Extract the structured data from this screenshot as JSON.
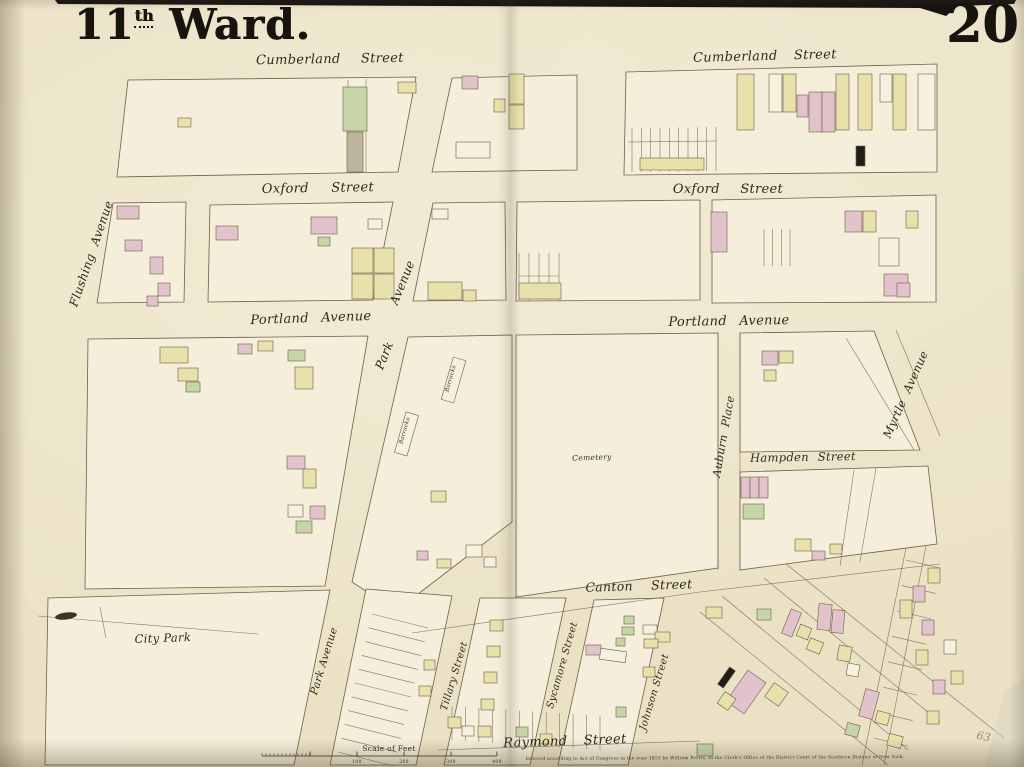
{
  "page": {
    "ward_number": "11",
    "ward_suffix": "th",
    "ward_word": "Ward.",
    "plate_number": "20"
  },
  "colors": {
    "paper": "#ebe2c6",
    "block": "#f4eeda",
    "ink": "#6b604a",
    "text_ink": "#2e2a1e",
    "pink": "#e2c2cb",
    "yellow": "#e9e1ab",
    "green": "#c8d5a9",
    "dark": "#211e18",
    "white": "#f6f1de",
    "grey": "#bdb59c",
    "pencil": "#908a76"
  },
  "map": {
    "labels": [
      {
        "n": "cumberland-street-left",
        "t": "Cumberland Street",
        "x": 330,
        "y": 63,
        "r": -1,
        "s": 13,
        "ws": 16
      },
      {
        "n": "cumberland-street-right",
        "t": "Cumberland Street",
        "x": 765,
        "y": 60,
        "r": -1.5,
        "s": 13,
        "ws": 12
      },
      {
        "n": "oxford-street-left",
        "t": "Oxford Street",
        "x": 318,
        "y": 192,
        "r": -1,
        "s": 13,
        "ws": 18
      },
      {
        "n": "oxford-street-right",
        "t": "Oxford Street",
        "x": 728,
        "y": 193,
        "r": 0,
        "s": 13,
        "ws": 16
      },
      {
        "n": "portland-avenue-left",
        "t": "Portland Avenue",
        "x": 311,
        "y": 322,
        "r": -2,
        "s": 13,
        "ws": 8
      },
      {
        "n": "portland-avenue-right",
        "t": "Portland Avenue",
        "x": 729,
        "y": 325,
        "r": -1,
        "s": 13,
        "ws": 8
      },
      {
        "n": "flushing-avenue",
        "t": "Flushing Avenue",
        "x": 95,
        "y": 255,
        "r": -71,
        "s": 12,
        "ws": 5
      },
      {
        "n": "park-avenue-upper-word-avenue",
        "t": "Avenue",
        "x": 406,
        "y": 284,
        "r": -68,
        "s": 12
      },
      {
        "n": "park-avenue-upper-word-park",
        "t": "Park",
        "x": 388,
        "y": 357,
        "r": -68,
        "s": 12
      },
      {
        "n": "barracks-upper",
        "t": "Barracks",
        "x": 452,
        "y": 379,
        "r": -74,
        "s": 5.5
      },
      {
        "n": "barracks-lower",
        "t": "Barracks",
        "x": 406,
        "y": 431,
        "r": -74,
        "s": 5.5
      },
      {
        "n": "cemetery",
        "t": "Cemetery",
        "x": 592,
        "y": 460,
        "r": -2,
        "s": 7.5
      },
      {
        "n": "auburn-place",
        "t": "Auburn Place",
        "x": 727,
        "y": 437,
        "r": -80,
        "s": 11,
        "ws": 4
      },
      {
        "n": "hampden-street",
        "t": "Hampden Street",
        "x": 803,
        "y": 461,
        "r": -1,
        "s": 11.5,
        "ws": 5
      },
      {
        "n": "myrtle-avenue",
        "t": "Myrtle Avenue",
        "x": 909,
        "y": 396,
        "r": -66,
        "s": 11.5,
        "ws": 5
      },
      {
        "n": "canton-street",
        "t": "Canton Street",
        "x": 639,
        "y": 590,
        "r": -2,
        "s": 12.5,
        "ws": 14
      },
      {
        "n": "city-park",
        "t": "City Park",
        "x": 163,
        "y": 642,
        "r": -2,
        "s": 11.5
      },
      {
        "n": "park-avenue-lower",
        "t": "Park Avenue",
        "x": 327,
        "y": 662,
        "r": -73,
        "s": 10.5
      },
      {
        "n": "tillary-street",
        "t": "Tillary Street",
        "x": 457,
        "y": 677,
        "r": -73,
        "s": 10
      },
      {
        "n": "sycamore-street",
        "t": "Sycamore Street",
        "x": 565,
        "y": 666,
        "r": -74,
        "s": 10
      },
      {
        "n": "johnson-street",
        "t": "Johnson Street",
        "x": 657,
        "y": 693,
        "r": -73,
        "s": 10
      },
      {
        "n": "raymond-street",
        "t": "Raymond Street",
        "x": 565,
        "y": 745,
        "r": -2,
        "s": 13,
        "ws": 12
      },
      {
        "n": "scale-of-feet",
        "t": "Scale of Feet",
        "x": 389,
        "y": 751,
        "r": 0,
        "s": 7.5,
        "u": 1
      },
      {
        "n": "imprint",
        "t": "Entered according to Act of Congress in the year 1855 by William Perris, in the Clerk's Office of the District Court of the Southern District of New York.",
        "x": 715,
        "y": 759,
        "r": -0.3,
        "s": 4.3,
        "u": 1
      },
      {
        "n": "pencil-mark",
        "t": "63",
        "x": 983,
        "y": 740,
        "r": 12,
        "s": 11,
        "c": "pencil"
      }
    ],
    "scale": {
      "ticks": [
        "100",
        "200",
        "300",
        "400"
      ]
    },
    "buildings": [
      [
        178,
        118,
        13,
        9,
        "y"
      ],
      [
        343,
        87,
        24,
        44,
        "g"
      ],
      [
        347,
        132,
        16,
        40,
        "grey"
      ],
      [
        398,
        82,
        18,
        11,
        "y"
      ],
      [
        462,
        76,
        16,
        13,
        "p"
      ],
      [
        509,
        74,
        15,
        30,
        "y"
      ],
      [
        509,
        105,
        15,
        24,
        "y"
      ],
      [
        494,
        99,
        11,
        13,
        "y"
      ],
      [
        456,
        142,
        34,
        16,
        "w"
      ],
      [
        737,
        74,
        17,
        56,
        "y"
      ],
      [
        769,
        74,
        13,
        38,
        "w"
      ],
      [
        783,
        74,
        13,
        38,
        "y"
      ],
      [
        797,
        95,
        11,
        22,
        "p"
      ],
      [
        809,
        92,
        13,
        40,
        "p"
      ],
      [
        822,
        92,
        13,
        40,
        "p"
      ],
      [
        836,
        74,
        13,
        56,
        "y"
      ],
      [
        858,
        74,
        14,
        56,
        "y"
      ],
      [
        880,
        74,
        12,
        28,
        "w"
      ],
      [
        893,
        74,
        13,
        56,
        "y"
      ],
      [
        918,
        74,
        17,
        56,
        "w"
      ],
      [
        856,
        146,
        9,
        20,
        "k"
      ],
      [
        640,
        158,
        64,
        12,
        "y"
      ],
      [
        117,
        206,
        22,
        13,
        "p"
      ],
      [
        125,
        240,
        17,
        11,
        "p"
      ],
      [
        150,
        257,
        13,
        17,
        "p"
      ],
      [
        158,
        283,
        12,
        13,
        "p"
      ],
      [
        147,
        296,
        11,
        10,
        "p"
      ],
      [
        216,
        226,
        22,
        14,
        "p"
      ],
      [
        311,
        217,
        26,
        17,
        "p"
      ],
      [
        318,
        237,
        12,
        9,
        "g"
      ],
      [
        352,
        248,
        21,
        25,
        "y"
      ],
      [
        374,
        248,
        20,
        25,
        "y"
      ],
      [
        352,
        274,
        21,
        25,
        "y"
      ],
      [
        374,
        274,
        20,
        25,
        "y"
      ],
      [
        368,
        219,
        14,
        10,
        "w"
      ],
      [
        432,
        209,
        16,
        10,
        "w"
      ],
      [
        428,
        282,
        34,
        18,
        "y"
      ],
      [
        463,
        290,
        13,
        11,
        "y"
      ],
      [
        519,
        283,
        42,
        16,
        "y"
      ],
      [
        711,
        212,
        16,
        40,
        "p"
      ],
      [
        845,
        211,
        17,
        21,
        "p"
      ],
      [
        863,
        211,
        13,
        21,
        "y"
      ],
      [
        879,
        238,
        20,
        28,
        "w"
      ],
      [
        884,
        274,
        24,
        22,
        "p"
      ],
      [
        906,
        211,
        12,
        17,
        "y"
      ],
      [
        897,
        283,
        13,
        14,
        "p"
      ],
      [
        160,
        347,
        28,
        16,
        "y"
      ],
      [
        178,
        368,
        20,
        13,
        "y"
      ],
      [
        186,
        382,
        14,
        10,
        "g"
      ],
      [
        238,
        344,
        14,
        10,
        "p"
      ],
      [
        258,
        341,
        15,
        10,
        "y"
      ],
      [
        288,
        350,
        17,
        11,
        "g"
      ],
      [
        295,
        367,
        18,
        22,
        "y"
      ],
      [
        287,
        456,
        18,
        13,
        "p"
      ],
      [
        303,
        469,
        13,
        19,
        "y"
      ],
      [
        288,
        505,
        15,
        12,
        "w"
      ],
      [
        310,
        506,
        15,
        13,
        "p"
      ],
      [
        296,
        521,
        16,
        12,
        "g"
      ],
      [
        447,
        358,
        13,
        44,
        "w",
        16
      ],
      [
        400,
        413,
        13,
        42,
        "w",
        16
      ],
      [
        431,
        491,
        15,
        11,
        "y"
      ],
      [
        417,
        551,
        11,
        9,
        "p"
      ],
      [
        437,
        559,
        14,
        9,
        "y"
      ],
      [
        466,
        545,
        16,
        12,
        "w"
      ],
      [
        484,
        557,
        12,
        10,
        "w"
      ],
      [
        762,
        351,
        16,
        14,
        "p"
      ],
      [
        779,
        351,
        14,
        12,
        "y"
      ],
      [
        764,
        370,
        12,
        11,
        "y"
      ],
      [
        741,
        477,
        9,
        21,
        "p"
      ],
      [
        750,
        477,
        9,
        21,
        "p"
      ],
      [
        759,
        477,
        9,
        21,
        "p"
      ],
      [
        743,
        504,
        21,
        15,
        "g"
      ],
      [
        795,
        539,
        16,
        12,
        "y"
      ],
      [
        812,
        551,
        13,
        9,
        "p"
      ],
      [
        830,
        544,
        12,
        10,
        "y"
      ],
      [
        424,
        660,
        11,
        10,
        "y"
      ],
      [
        419,
        686,
        12,
        10,
        "y"
      ],
      [
        490,
        620,
        13,
        11,
        "y"
      ],
      [
        487,
        646,
        13,
        11,
        "y"
      ],
      [
        484,
        672,
        13,
        11,
        "y"
      ],
      [
        481,
        699,
        13,
        11,
        "y"
      ],
      [
        478,
        726,
        13,
        11,
        "y"
      ],
      [
        624,
        616,
        10,
        8,
        "g"
      ],
      [
        622,
        627,
        12,
        8,
        "g"
      ],
      [
        616,
        638,
        9,
        8,
        "g"
      ],
      [
        643,
        625,
        14,
        9,
        "w"
      ],
      [
        655,
        632,
        15,
        10,
        "y"
      ],
      [
        644,
        639,
        14,
        9,
        "y"
      ],
      [
        586,
        645,
        15,
        10,
        "p"
      ],
      [
        600,
        650,
        26,
        11,
        "w",
        8
      ],
      [
        643,
        667,
        12,
        10,
        "y"
      ],
      [
        616,
        707,
        10,
        10,
        "g"
      ],
      [
        448,
        717,
        13,
        11,
        "y"
      ],
      [
        462,
        726,
        12,
        10,
        "w"
      ],
      [
        516,
        727,
        12,
        10,
        "g"
      ],
      [
        540,
        734,
        12,
        10,
        "y"
      ],
      [
        706,
        607,
        16,
        11,
        "y"
      ],
      [
        757,
        609,
        14,
        11,
        "g"
      ],
      [
        786,
        610,
        11,
        26,
        "p",
        22
      ],
      [
        798,
        626,
        12,
        12,
        "y",
        22
      ],
      [
        723,
        667,
        7,
        21,
        "k",
        35
      ],
      [
        735,
        673,
        22,
        38,
        "p",
        35
      ],
      [
        720,
        694,
        13,
        14,
        "y",
        35
      ],
      [
        768,
        686,
        17,
        17,
        "y",
        35
      ],
      [
        808,
        640,
        14,
        12,
        "y",
        22
      ],
      [
        818,
        604,
        13,
        26,
        "p",
        5
      ],
      [
        832,
        610,
        12,
        23,
        "p",
        5
      ],
      [
        838,
        646,
        13,
        15,
        "y",
        10
      ],
      [
        847,
        664,
        12,
        12,
        "w",
        10
      ],
      [
        862,
        690,
        14,
        28,
        "p",
        15
      ],
      [
        876,
        712,
        13,
        12,
        "y",
        15
      ],
      [
        846,
        724,
        13,
        12,
        "g",
        15
      ],
      [
        888,
        735,
        14,
        12,
        "y",
        15
      ],
      [
        900,
        600,
        12,
        18,
        "y"
      ],
      [
        913,
        586,
        12,
        16,
        "p"
      ],
      [
        928,
        568,
        12,
        15,
        "y"
      ],
      [
        922,
        620,
        12,
        15,
        "p"
      ],
      [
        916,
        650,
        12,
        15,
        "y"
      ],
      [
        933,
        680,
        12,
        14,
        "p"
      ],
      [
        927,
        711,
        12,
        13,
        "y"
      ],
      [
        944,
        640,
        12,
        14,
        "w"
      ],
      [
        951,
        671,
        12,
        13,
        "y"
      ],
      [
        697,
        744,
        16,
        12,
        "g"
      ]
    ]
  }
}
